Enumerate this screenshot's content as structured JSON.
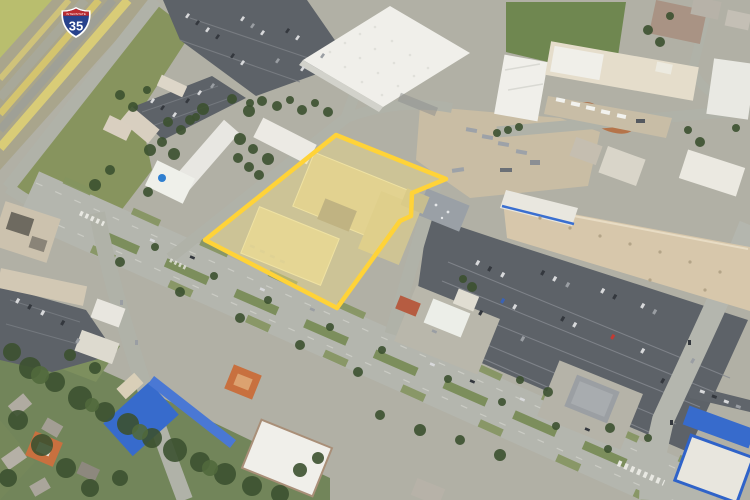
{
  "view": {
    "kind": "satellite-aerial",
    "route_shield": {
      "number": "35",
      "band_text": "INTERSTATE"
    },
    "palette": {
      "base": "#B1B0A5",
      "grass": "#87945E",
      "grassBright": "#B9BE6E",
      "grassDark": "#6F8750",
      "tree": "#3C5130",
      "road": "#B4B6AE",
      "roadMinor": "#B0B2A8",
      "parking": "#5D6268",
      "roofWhite": "#F0EFEA",
      "roofBeige": "#D7C7AB",
      "roofTan": "#D3C99B",
      "roofBlue": "#376BCC",
      "roofOrange": "#C8703F",
      "roofGray": "#9B9FA3",
      "dirt": "#C9BDA4",
      "parcelFill": "#F9E27E",
      "parcelOutline": "#FFD338",
      "shieldBlue": "#27428C",
      "shieldRed": "#BB2B30"
    }
  }
}
